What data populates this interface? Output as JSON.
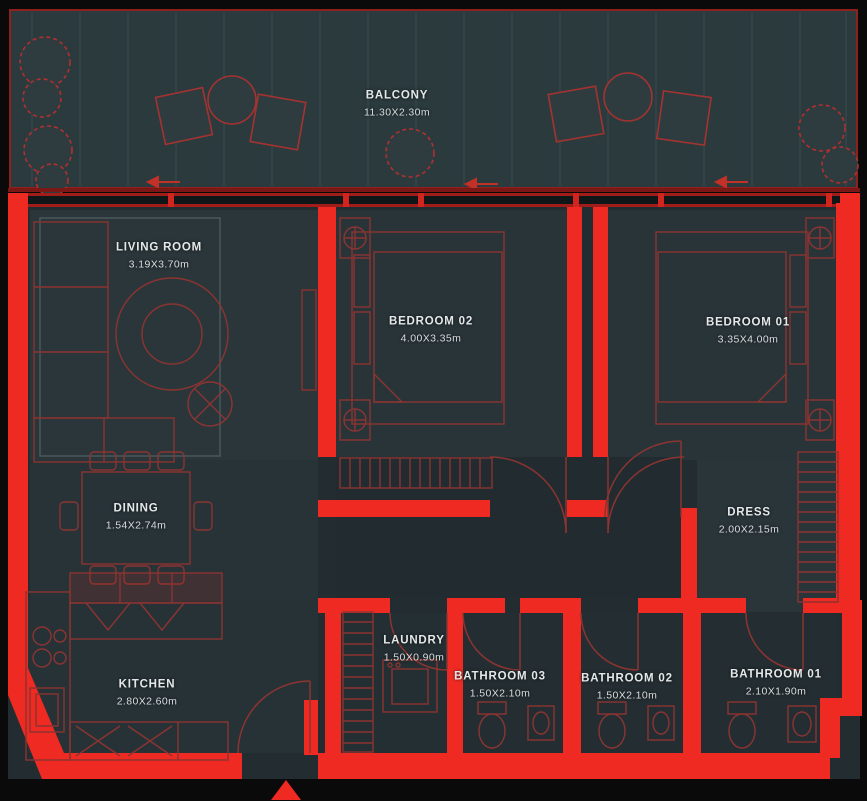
{
  "plan": {
    "kind": "apartment-floor-plan",
    "colors": {
      "background": "#0a0a0a",
      "wall_red": "#ee2a23",
      "furniture_outline_red": "#8b3431",
      "floor_dark": "#232d31",
      "floor_room": "#2b363a",
      "balcony_floor": "#2a3a3d",
      "label_text": "#e4e8e9"
    },
    "entrance_marker": "red-triangle-up"
  },
  "rooms": {
    "balcony": {
      "name": "BALCONY",
      "dims": "11.30X2.30m"
    },
    "living_room": {
      "name": "LIVING ROOM",
      "dims": "3.19X3.70m"
    },
    "bedroom_02": {
      "name": "BEDROOM 02",
      "dims": "4.00X3.35m"
    },
    "bedroom_01": {
      "name": "BEDROOM 01",
      "dims": "3.35X4.00m"
    },
    "dining": {
      "name": "DINING",
      "dims": "1.54X2.74m"
    },
    "dress": {
      "name": "DRESS",
      "dims": "2.00X2.15m"
    },
    "kitchen": {
      "name": "KITCHEN",
      "dims": "2.80X2.60m"
    },
    "laundry": {
      "name": "LAUNDRY",
      "dims": "1.50X0.90m"
    },
    "bathroom_03": {
      "name": "BATHROOM 03",
      "dims": "1.50X2.10m"
    },
    "bathroom_02": {
      "name": "BATHROOM 02",
      "dims": "1.50X2.10m"
    },
    "bathroom_01": {
      "name": "BATHROOM 01",
      "dims": "2.10X1.90m"
    }
  }
}
